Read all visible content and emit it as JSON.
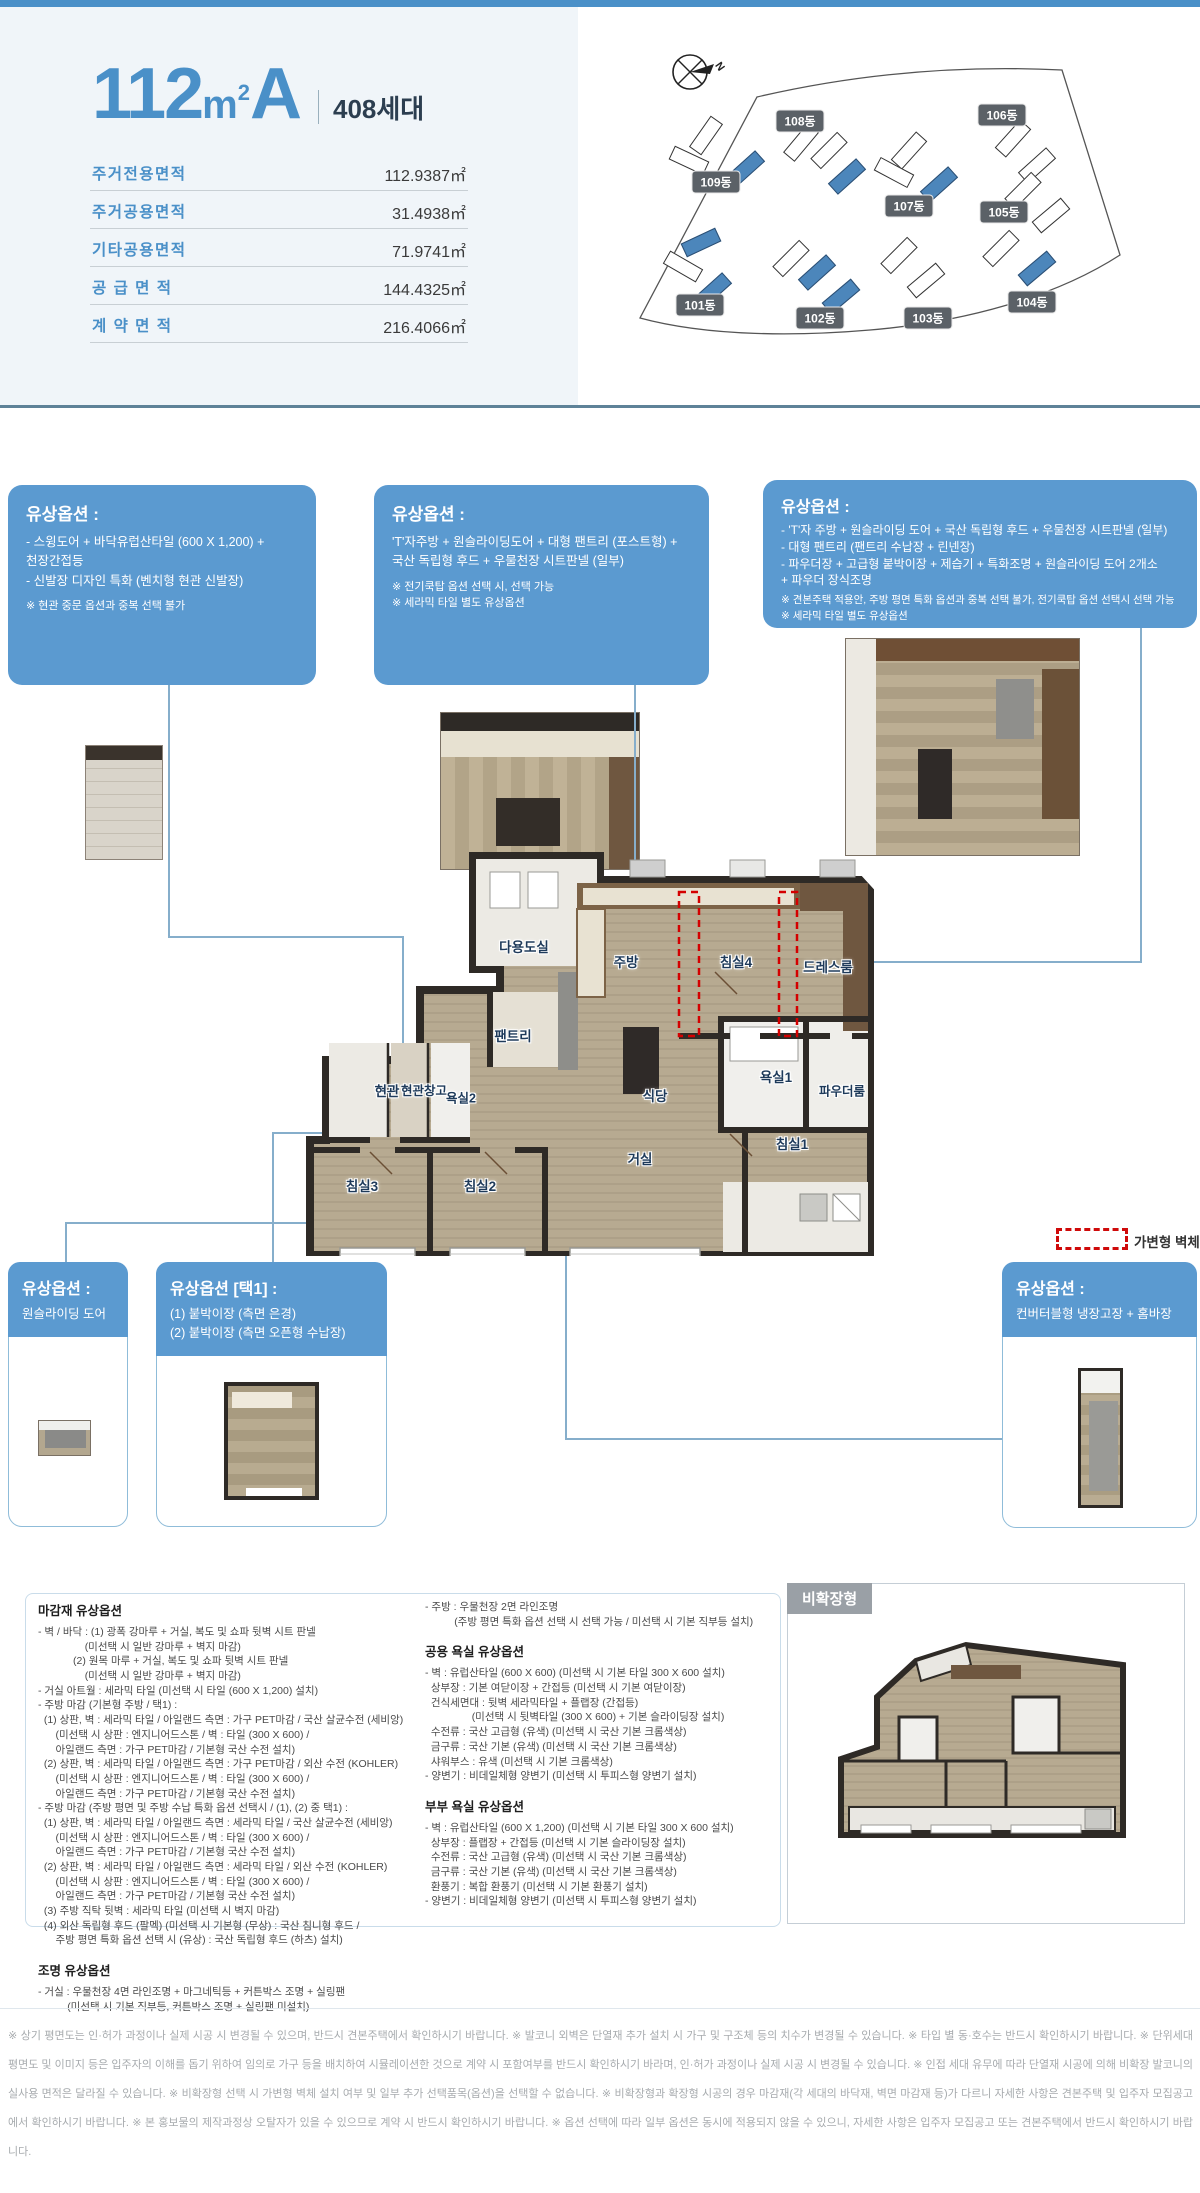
{
  "header": {
    "title_number": "112",
    "title_unit": "m",
    "title_sup": "2",
    "title_type": "A",
    "units": "408세대",
    "area_table": [
      {
        "label": "주거전용면적",
        "value": "112.9387㎡"
      },
      {
        "label": "주거공용면적",
        "value": "31.4938㎡"
      },
      {
        "label": "기타공용면적",
        "value": "71.9741㎡"
      },
      {
        "label": "공 급 면 적",
        "value": "144.4325㎡"
      },
      {
        "label": "계 약 면 적",
        "value": "216.4066㎡"
      }
    ]
  },
  "site_map": {
    "north": "N",
    "buildings": [
      {
        "label": "101동"
      },
      {
        "label": "102동"
      },
      {
        "label": "103동"
      },
      {
        "label": "104동"
      },
      {
        "label": "105동"
      },
      {
        "label": "106동"
      },
      {
        "label": "107동"
      },
      {
        "label": "108동"
      },
      {
        "label": "109동"
      }
    ]
  },
  "options_top": [
    {
      "title": "유상옵션 :",
      "body": "- 스윙도어 + 바닥유럽산타일 (600 X 1,200) +\n  천장간접등\n- 신발장 디자인 특화 (벤치형 현관 신발장)",
      "notes": "※ 현관 중문 옵션과 중복 선택 불가"
    },
    {
      "title": "유상옵션 :",
      "body": "'T'자주방 + 원슬라이딩도어 + 대형 팬트리 (포스트형) +\n국산 독립형 후드 + 우물천장 시트판넬 (일부)",
      "notes": "※ 전기쿡탑 옵션 선택 시, 선택 가능\n※ 세라믹 타일 별도 유상옵션"
    },
    {
      "title": "유상옵션 :",
      "body": "- 'T'자 주방 + 원슬라이딩 도어 + 국산 독립형 후드 + 우물천장 시트판넬 (일부)\n- 대형 팬트리 (팬트리 수납장 + 린넨장)\n- 파우더장 + 고급형 붙박이장 + 제습기 + 특화조명 + 원슬라이딩 도어 2개소\n  + 파우더 장식조명",
      "notes": "※ 견본주택 적용안, 주방 평면 특화 옵션과 중복 선택 불가, 전기쿡탑 옵션 선택시 선택 가능\n※ 세라믹 타일 별도 유상옵션"
    }
  ],
  "floor_plan": {
    "legend": "가변형 벽체",
    "rooms": {
      "utility": "다용도실",
      "kitchen": "주방",
      "bed4": "침실4",
      "dress": "드레스룸",
      "pantry": "팬트리",
      "entrance": "현관",
      "entrance_storage": "현관창고",
      "bath2": "욕실2",
      "dining": "식당",
      "bath1": "욕실1",
      "powder": "파우더룸",
      "living": "거실",
      "bed1": "침실1",
      "bed2": "침실2",
      "bed3": "침실3"
    }
  },
  "options_bottom": [
    {
      "title": "유상옵션 :",
      "body": "원슬라이딩 도어"
    },
    {
      "title": "유상옵션 [택1] :",
      "body": "(1) 붙박이장 (측면 은경)\n(2) 붙박이장 (측면 오픈형 수납장)"
    },
    {
      "title": "유상옵션 :",
      "body": "컨버터블형 냉장고장 + 홈바장"
    }
  ],
  "specs": {
    "finish_title": "마감재 유상옵션",
    "finish_body": "- 벽 / 바닥 : (1) 광폭 강마루 + 거실, 복도 및 쇼파 뒷벽 시트 판넬\n                (미선택 시 일반 강마루 + 벽지 마감)\n            (2) 원목 마루 + 거실, 복도 및 쇼파 뒷벽 시트 판넬\n                (미선택 시 일반 강마루 + 벽지 마감)\n- 거실 아트월 : 세라믹 타일 (미선택 시 타일 (600 X 1,200) 설치)\n- 주방 마감 (기본형 주방 / 택1) :\n  (1) 상판, 벽 : 세라믹 타일 / 아일랜드 측면 : 가구 PET마감 / 국산 살균수전 (세비앙)\n      (미선택 시 상판 : 엔지니어드스톤 / 벽 : 타일 (300 X 600) /\n      아일랜드 측면 : 가구 PET마감 / 기본형 국산 수전 설치)\n  (2) 상판, 벽 : 세라믹 타일 / 아일랜드 측면 : 가구 PET마감 / 외산 수전 (KOHLER)\n      (미선택 시 상판 : 엔지니어드스톤 / 벽 : 타일 (300 X 600) /\n      아일랜드 측면 : 가구 PET마감 / 기본형 국산 수전 설치)\n- 주방 마감 (주방 평면 및 주방 수납 특화 옵션 선택시 / (1), (2) 중 택1) :\n  (1) 상판, 벽 : 세라믹 타일 / 아일랜드 측면 : 세라믹 타일 / 국산 살균수전 (세비앙)\n      (미선택 시 상판 : 엔지니어드스톤 / 벽 : 타일 (300 X 600) /\n      아일랜드 측면 : 가구 PET마감 / 기본형 국산 수전 설치)\n  (2) 상판, 벽 : 세라믹 타일 / 아일랜드 측면 : 세라믹 타일 / 외산 수전 (KOHLER)\n      (미선택 시 상판 : 엔지니어드스톤 / 벽 : 타일 (300 X 600) /\n      아일랜드 측면 : 가구 PET마감 / 기본형 국산 수전 설치)\n  (3) 주방 직탁 뒷벽 : 세라믹 타일 (미선택 시 벽지 마감)\n  (4) 외산 독립형 후드 (팔멕) (미선택 시 기본형 (무상) : 국산 침니형 후드 /\n      주방 평면 특화 옵션 선택 시 (유상) : 국산 독립형 후드 (하츠) 설치)",
    "lighting_title": "조명 유상옵션",
    "lighting_body": "- 거실 : 우물천장 4면 라인조명 + 마그네틱등 + 커튼박스 조명 + 실링팬\n          (미선택 시 기본 직부등, 커튼박스 조명 + 실링팬 미설치)",
    "lighting_body2": "- 주방 : 우물천장 2면 라인조명\n          (주방 평면 특화 옵션 선택 시 선택 가능 / 미선택 시 기본 직부등 설치)",
    "common_bath_title": "공용 욕실 유상옵션",
    "common_bath_body": "- 벽 : 유럽산타일 (600 X 600) (미선택 시 기본 타일 300 X 600 설치)\n  상부장 : 기본 여닫이장 + 간접등 (미선택 시 기본 여닫이장)\n  건식세면대 : 뒷벽 세라믹타일 + 플랩장 (간접등)\n                (미선택 시 뒷벽타일 (300 X 600) + 기본 슬라이딩장 설치)\n  수전류 : 국산 고급형 (유색) (미선택 시 국산 기본 크롬색상)\n  금구류 : 국산 기본 (유색) (미선택 시 국산 기본 크롬색상)\n  샤워부스 : 유색 (미선택 시 기본 크롬색상)\n- 양변기 : 비데일체형 양변기 (미선택 시 투피스형 양변기 설치)",
    "master_bath_title": "부부 욕실 유상옵션",
    "master_bath_body": "- 벽 : 유럽산타일 (600 X 1,200) (미선택 시 기본 타일 300 X 600 설치)\n  상부장 : 플랩장 + 간접등 (미선택 시 기본 슬라이딩장 설치)\n  수전류 : 국산 고급형 (유색) (미선택 시 국산 기본 크롬색상)\n  금구류 : 국산 기본 (유색) (미선택 시 국산 기본 크롬색상)\n  환풍기 : 복합 환풍기 (미선택 시 기본 환풍기 설치)\n- 양변기 : 비데일체형 양변기 (미선택 시 투피스형 양변기 설치)",
    "nonexpanded_label": "비확장형"
  },
  "disclaimer": "※ 상기 평면도는 인·허가 과정이나 실제 시공 시 변경될 수 있으며, 반드시 견본주택에서 확인하시기 바랍니다. ※ 발코니 외벽은 단열재 추가 설치 시 가구 및 구조체 등의 치수가 변경될 수 있습니다. ※ 타입 별 동·호수는 반드시 확인하시기 바랍니다. ※ 단위세대 평면도 및 이미지 등은 입주자의 이해를 돕기 위하여 임의로 가구 등을 배치하여 시뮬레이션한 것으로 계약 시 포함여부를 반드시 확인하시기 바라며, 인·허가 과정이나 실제 시공 시 변경될 수 있습니다. ※ 인접 세대 유무에 따라 단열재 시공에 의해 비확장 발코니의 실사용 면적은 달라질 수 있습니다. ※ 비확장형 선택 시 가변형 벽체 설치 여부 및 일부 추가 선택품목(옵션)을 선택할 수 없습니다. ※ 비확장형과 확장형 시공의 경우 마감재(각 세대의 바닥재, 벽면 마감재 등)가 다르니 자세한 사항은 견본주택 및 입주자 모집공고에서 확인하시기 바랍니다. ※ 본 홍보물의 제작과정상 오탈자가 있을 수 있으므로 계약 시 반드시 확인하시기 바랍니다. ※ 옵션 선택에 따라 일부 옵션은 동시에 적용되지 않을 수 있으니, 자세한 사항은 입주자 모집공고 또는 견본주택에서 반드시 확인하시기 바랍니다."
}
